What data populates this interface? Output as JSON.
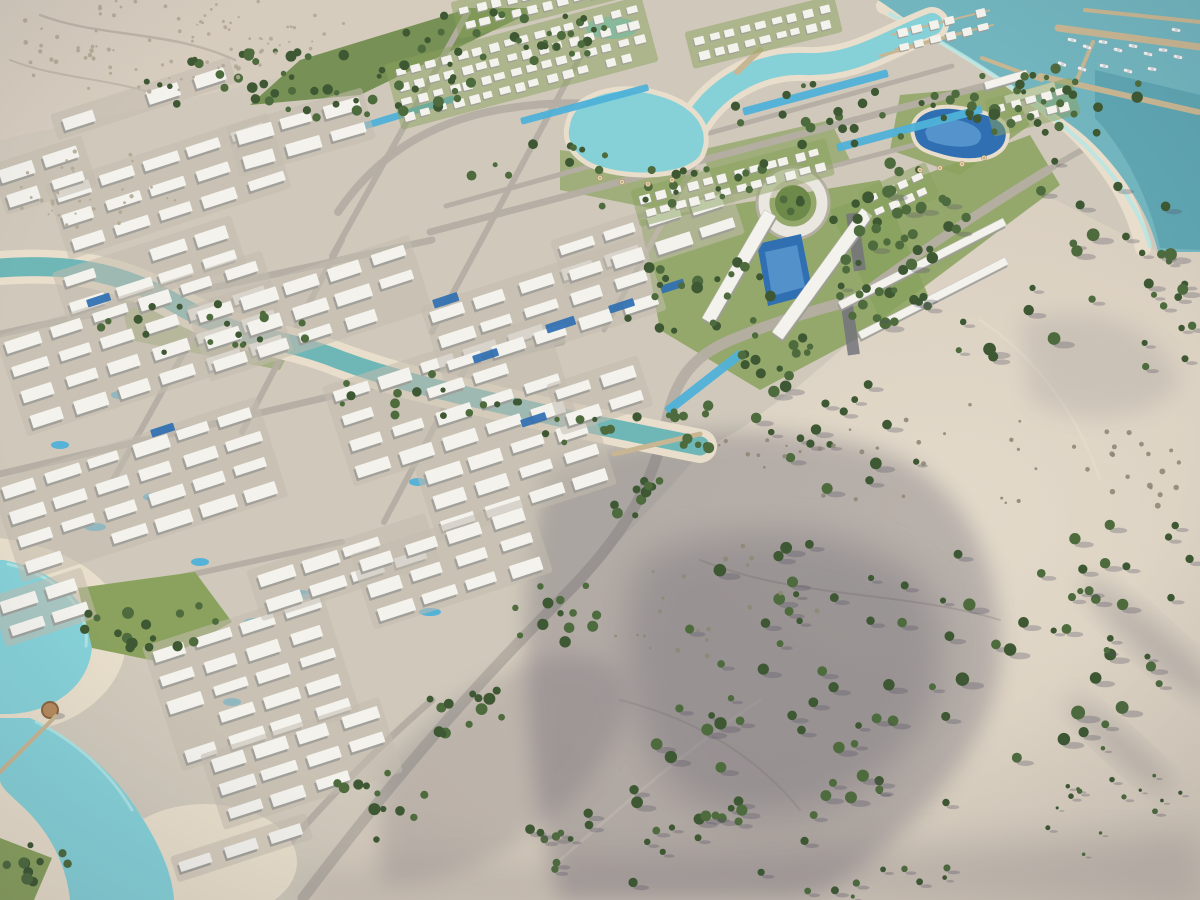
{
  "meta": {
    "title": "Aerial render — coastal desert resort masterplan",
    "type": "architectural-visualization-photo",
    "description": "High-angle aerial 3D rendering of a large master-planned resort community: dense rows of white low-rise apartment blocks and villas with courtyard pools, turquoise lagoons and a winding canal, green street trees, a marina with piers and moored boats on a teal sea at the top right, and open beige desert with scattered shrubs and long dune shadows occupying the right and lower-right of the frame.",
    "no_visible_text": true
  },
  "palette": {
    "sand": "#d8cec0",
    "sand2": "#e3dacb",
    "dev": "#d0c9bb",
    "dev2": "#c3bcae",
    "road": "#b4aea3",
    "bldg": "#f3f2ed",
    "bldg_sh": "#9d9c98",
    "lawn": "#8aa25e",
    "lawn2": "#6d8a4a",
    "tree": "#4e6b3e",
    "tree2": "#3e5833",
    "scrub": "#b2a794",
    "scrub2": "#8f8878",
    "sea": "#72b5be",
    "sea_deep": "#4f98a5",
    "lagoon": "#86d1d8",
    "lagoon2": "#b2e6e6",
    "canal": "#6fb7b6",
    "beach": "#e8decb",
    "pool": "#2f6fb2",
    "pool2": "#4fb1d8",
    "pier": "#c8b692",
    "shadow": "#565264",
    "boat": "#f2f4f4",
    "hut": "#b68a5e",
    "ring": "#e9e7e0",
    "dark": "#73737b"
  },
  "scene": {
    "regions": [
      {
        "name": "sea-marina",
        "desc": "teal sea with two breakwater piers and moored yachts, top right corner"
      },
      {
        "name": "overwater-bungalows",
        "desc": "two rows of white overwater cabins on the shore edge"
      },
      {
        "name": "desert",
        "desc": "beige sand slope with scrub trees and long purple-grey dune shadows, right half and bottom"
      },
      {
        "name": "development",
        "desc": "diagonal band of white residential blocks from lower left to the marina"
      },
      {
        "name": "lagoon-chain",
        "desc": "winding turquoise lagoons with sandy beaches across the upper center"
      },
      {
        "name": "canal",
        "desc": "teal canal crossing the dense district from the left edge to a central dock"
      },
      {
        "name": "south-lagoon",
        "desc": "pale turquoise lagoon with beaches, jetty and thatched hut, bottom left"
      },
      {
        "name": "v-towers",
        "desc": "V-shaped landmark towers with circular ring road and blue pool, upper center"
      }
    ],
    "building_clusters": [
      [
        55,
        190,
        -18,
        3,
        5,
        "a"
      ],
      [
        62,
        278,
        -18,
        2,
        4,
        "a"
      ],
      [
        235,
        132,
        -16,
        2,
        3,
        "a"
      ],
      [
        5,
        342,
        -18,
        4,
        6,
        "a"
      ],
      [
        0,
        488,
        -18,
        4,
        6,
        "a"
      ],
      [
        196,
        312,
        -18,
        3,
        5,
        "a"
      ],
      [
        332,
        392,
        -18,
        4,
        5,
        "a"
      ],
      [
        152,
        652,
        -18,
        5,
        4,
        "a"
      ],
      [
        256,
        576,
        -18,
        2,
        4,
        "a"
      ],
      [
        0,
        602,
        -18,
        2,
        2,
        "a"
      ],
      [
        430,
        312,
        -18,
        3,
        5,
        "a"
      ],
      [
        424,
        472,
        -18,
        3,
        4,
        "a"
      ],
      [
        560,
        246,
        -18,
        2,
        4,
        "a"
      ],
      [
        210,
        760,
        -18,
        3,
        4,
        "a"
      ],
      [
        180,
        862,
        -18,
        1,
        3,
        "a"
      ],
      [
        360,
        560,
        -18,
        3,
        4,
        "a"
      ],
      [
        0,
        170,
        -18,
        2,
        2,
        "a"
      ],
      [
        60,
        120,
        -18,
        1,
        4,
        "a"
      ],
      [
        556,
        390,
        -18,
        2,
        2,
        "a"
      ],
      [
        394,
        70,
        -15,
        4,
        16,
        "v"
      ],
      [
        640,
        196,
        -15,
        2,
        12,
        "v"
      ],
      [
        694,
        38,
        -14,
        2,
        9,
        "v"
      ],
      [
        994,
        106,
        -15,
        2,
        5,
        "v"
      ],
      [
        460,
        8,
        -14,
        2,
        10,
        "v"
      ],
      [
        868,
        196,
        -24,
        2,
        4,
        "v"
      ],
      [
        896,
        30,
        -14,
        2,
        6,
        "o"
      ]
    ],
    "building_bars": [
      [
        838,
        302,
        185,
        8,
        -27
      ],
      [
        858,
        332,
        165,
        8,
        -27
      ],
      [
        702,
        318,
        125,
        13,
        -60
      ],
      [
        772,
        332,
        153,
        13,
        -54
      ],
      [
        984,
        82,
        44,
        8,
        -16
      ],
      [
        1004,
        96,
        52,
        8,
        -16
      ]
    ],
    "dark_strips": [
      [
        846,
        214,
        12,
        58,
        -8
      ],
      [
        841,
        306,
        12,
        50,
        -8
      ]
    ],
    "roads": [
      {
        "d": "M303,898 C400,770 480,680 562,598 C640,520 656,468 668,415 C678,372 700,352 736,338 C780,320 822,308 854,300",
        "w": 11
      },
      {
        "d": "M854,300 C930,244 992,204 1048,170",
        "w": 9
      },
      {
        "d": "M1048,170 C1080,150 1108,136 1126,130",
        "w": 6
      },
      {
        "d": "M338,212 C380,150 440,118 510,108 C562,100 612,102 658,116",
        "w": 8
      },
      {
        "d": "M430,232 L1014,78",
        "w": 7
      },
      {
        "d": "M446,206 L952,66",
        "w": 5
      },
      {
        "d": "M640,216 L1042,112",
        "w": 5
      },
      {
        "d": "M0,334 L432,240",
        "w": 7
      },
      {
        "d": "M0,474 L562,342",
        "w": 7
      },
      {
        "d": "M0,616 L342,542",
        "w": 6
      },
      {
        "d": "M240,898 C300,830 362,760 432,700",
        "w": 7
      },
      {
        "d": "M468,12 L332,256",
        "w": 6
      },
      {
        "d": "M588,42 L432,332",
        "w": 6
      },
      {
        "d": "M702,150 L604,330",
        "w": 5
      },
      {
        "d": "M342,240 L242,432",
        "w": 6
      },
      {
        "d": "M212,302 L112,482",
        "w": 6
      },
      {
        "d": "M474,352 L384,522",
        "w": 6
      }
    ],
    "piers": [
      [
        1058,
        28,
        1200,
        47,
        7
      ],
      [
        1040,
        76,
        1198,
        112,
        6
      ],
      [
        1093,
        42,
        1076,
        82,
        4
      ],
      [
        982,
        58,
        1042,
        80,
        4
      ],
      [
        1085,
        10,
        1200,
        22,
        4
      ],
      [
        614,
        454,
        700,
        434,
        5
      ],
      [
        0,
        772,
        56,
        716,
        4
      ],
      [
        737,
        72,
        760,
        50,
        6
      ],
      [
        880,
        56,
        972,
        30,
        3
      ]
    ],
    "boats": [
      [
        1072,
        40,
        12
      ],
      [
        1087,
        47,
        18
      ],
      [
        1103,
        42,
        8
      ],
      [
        1118,
        50,
        15
      ],
      [
        1133,
        46,
        10
      ],
      [
        1148,
        54,
        14
      ],
      [
        1163,
        50,
        6
      ],
      [
        1178,
        57,
        12
      ],
      [
        1062,
        64,
        22
      ],
      [
        1082,
        69,
        18
      ],
      [
        1104,
        66,
        12
      ],
      [
        1128,
        71,
        16
      ],
      [
        1152,
        69,
        8
      ],
      [
        1044,
        98,
        38
      ],
      [
        1058,
        108,
        32
      ],
      [
        1176,
        30,
        10
      ]
    ],
    "pools": {
      "linear": [
        [
          346,
          128,
          112,
          7,
          -17
        ],
        [
          520,
          118,
          132,
          7,
          -15
        ],
        [
          742,
          108,
          150,
          8,
          -15
        ],
        [
          836,
          144,
          150,
          8,
          -15
        ],
        [
          664,
          408,
          95,
          9,
          -38
        ]
      ],
      "rooftop": [
        [
          432,
          300,
          26,
          9,
          -18
        ],
        [
          545,
          325,
          30,
          9,
          -18
        ],
        [
          608,
          306,
          26,
          8,
          -18
        ],
        [
          660,
          286,
          24,
          8,
          -18
        ],
        [
          472,
          356,
          26,
          8,
          -18
        ],
        [
          520,
          420,
          26,
          8,
          -18
        ],
        [
          86,
          300,
          24,
          8,
          -18
        ],
        [
          150,
          430,
          24,
          8,
          -18
        ]
      ],
      "courtyard": [
        [
          300,
          595,
          13,
          5
        ],
        [
          255,
          622,
          11,
          4
        ],
        [
          200,
          562,
          9,
          4
        ],
        [
          95,
          527,
          11,
          4
        ],
        [
          152,
          497,
          9,
          4
        ],
        [
          365,
          547,
          9,
          4
        ],
        [
          430,
          612,
          11,
          4
        ],
        [
          332,
          682,
          9,
          4
        ],
        [
          232,
          702,
          9,
          4
        ],
        [
          418,
          482,
          9,
          4
        ],
        [
          120,
          395,
          9,
          4
        ],
        [
          60,
          445,
          9,
          4
        ]
      ]
    },
    "trees": [
      [
        310,
        82,
        170,
        38,
        55,
        2.5,
        5.5,
        0,
        "t"
      ],
      [
        500,
        36,
        120,
        26,
        32,
        2.5,
        5,
        0,
        "t"
      ],
      [
        620,
        172,
        150,
        36,
        28,
        2.5,
        5,
        0,
        "t"
      ],
      [
        858,
        116,
        130,
        34,
        24,
        2.5,
        5,
        0,
        "t"
      ],
      [
        700,
        292,
        85,
        58,
        22,
        3,
        6,
        0,
        "t"
      ],
      [
        888,
        236,
        66,
        44,
        15,
        3,
        6,
        0,
        "t"
      ],
      [
        998,
        92,
        84,
        30,
        16,
        2.5,
        5,
        0,
        "t"
      ],
      [
        205,
        328,
        120,
        26,
        20,
        2.5,
        5,
        0,
        "t"
      ],
      [
        432,
        396,
        108,
        22,
        15,
        2.5,
        5,
        0,
        "t"
      ],
      [
        148,
        622,
        72,
        30,
        16,
        3,
        6,
        0,
        "t"
      ],
      [
        46,
        864,
        42,
        24,
        10,
        3,
        6,
        0,
        "t"
      ],
      [
        560,
        614,
        52,
        34,
        13,
        3,
        6,
        0,
        "t"
      ],
      [
        466,
        706,
        52,
        34,
        13,
        3,
        6,
        0,
        "t"
      ],
      [
        376,
        806,
        52,
        34,
        12,
        3,
        6,
        0,
        "t"
      ],
      [
        650,
        506,
        42,
        26,
        10,
        3,
        5.5,
        0,
        "t"
      ],
      [
        706,
        426,
        48,
        22,
        11,
        3,
        5.5,
        0,
        "t"
      ],
      [
        790,
        356,
        52,
        22,
        12,
        3,
        5.5,
        0,
        "t"
      ],
      [
        864,
        306,
        52,
        20,
        11,
        3,
        5.5,
        0,
        "t"
      ],
      [
        1014,
        262,
        185,
        105,
        36,
        3,
        6.5,
        1,
        "t"
      ],
      [
        900,
        662,
        245,
        145,
        50,
        3,
        7,
        1,
        "t"
      ],
      [
        1130,
        592,
        65,
        105,
        20,
        3,
        6,
        1,
        "t"
      ],
      [
        772,
        762,
        125,
        85,
        24,
        3,
        6.5,
        1,
        "t"
      ],
      [
        652,
        832,
        105,
        55,
        14,
        3,
        6,
        1,
        "t"
      ],
      [
        1062,
        106,
        95,
        40,
        18,
        3,
        6,
        0,
        "t"
      ],
      [
        1162,
        322,
        38,
        55,
        10,
        3,
        5.5,
        1,
        "t"
      ],
      [
        540,
        856,
        55,
        28,
        7,
        2.5,
        5,
        1,
        "t"
      ],
      [
        840,
        430,
        90,
        60,
        18,
        3,
        6,
        1,
        "t"
      ],
      [
        140,
        46,
        140,
        46,
        60,
        1,
        2.4,
        0,
        "s"
      ],
      [
        92,
        192,
        88,
        44,
        34,
        1,
        2.2,
        0,
        "s"
      ],
      [
        262,
        26,
        88,
        28,
        26,
        1,
        2,
        0,
        "s"
      ],
      [
        950,
        452,
        235,
        55,
        36,
        1.2,
        2.6,
        0,
        "g"
      ],
      [
        1100,
        802,
        85,
        55,
        16,
        1.5,
        3,
        1,
        "t"
      ],
      [
        862,
        880,
        145,
        18,
        10,
        2,
        4,
        1,
        "t"
      ],
      [
        1150,
        470,
        45,
        40,
        12,
        1.5,
        3,
        0,
        "g"
      ],
      [
        700,
        600,
        120,
        60,
        20,
        1.2,
        2.6,
        0,
        "g"
      ],
      [
        793,
        203,
        14,
        14,
        4,
        3,
        5,
        0,
        "t"
      ],
      [
        900,
        205,
        75,
        45,
        12,
        3,
        6,
        0,
        "t"
      ],
      [
        600,
        430,
        60,
        18,
        9,
        2.5,
        5,
        0,
        "t"
      ]
    ],
    "umbrellas": [
      [
        600,
        178
      ],
      [
        622,
        182
      ],
      [
        648,
        184
      ],
      [
        672,
        180
      ],
      [
        940,
        168
      ],
      [
        962,
        164
      ],
      [
        984,
        158
      ],
      [
        920,
        170
      ]
    ]
  }
}
